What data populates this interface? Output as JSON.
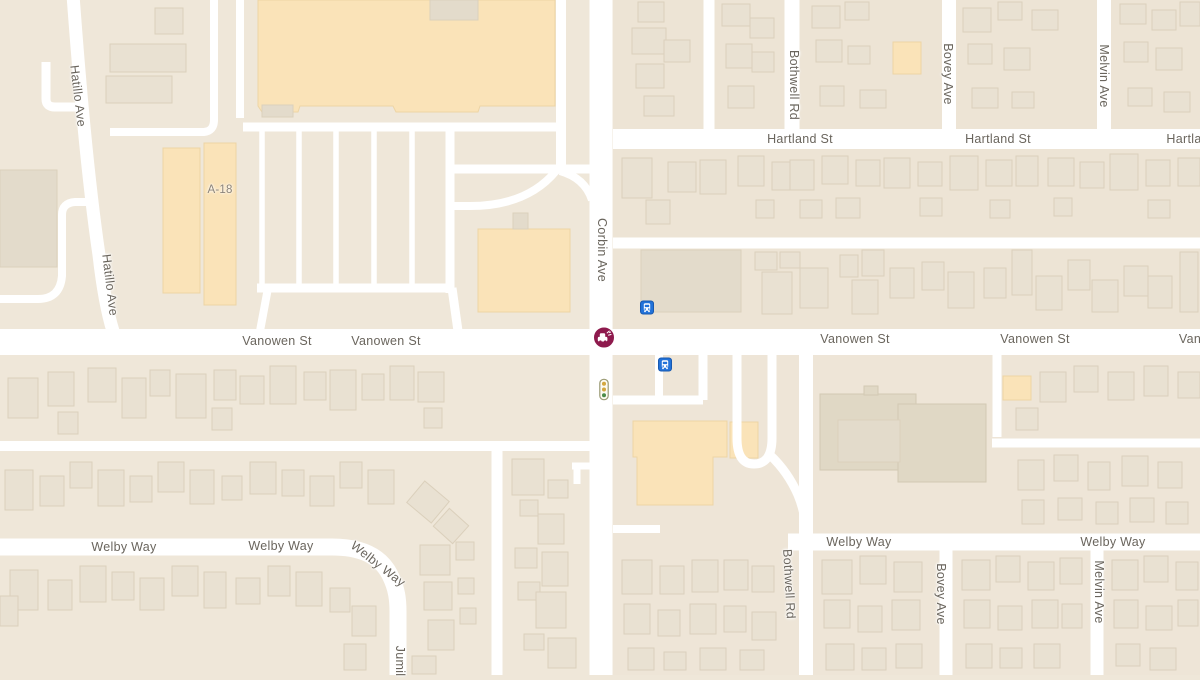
{
  "colors": {
    "background": "#EFE7D9",
    "block_tint": "#EDE4D5",
    "road": "#FFFFFF",
    "building": "#E9E1D2",
    "building_dark": "#E3DBCB",
    "commercial": "#FAE3B8",
    "church": "#E0D8C5",
    "label_text": "#6A655D",
    "incident": "#8E1A4D",
    "bus_blue": "#2272D9",
    "light_amber": "#D3A73F",
    "light_green": "#4C8B47"
  },
  "map": {
    "street_labels": [
      {
        "text": "Hatillo Ave",
        "x": 78,
        "y": 96,
        "rotate": 83
      },
      {
        "text": "Hatillo Ave",
        "x": 110,
        "y": 285,
        "rotate": 83
      },
      {
        "text": "Corbin Ave",
        "x": 602,
        "y": 250,
        "rotate": 90
      },
      {
        "text": "Hartland St",
        "x": 800,
        "y": 139,
        "rotate": 0
      },
      {
        "text": "Hartland St",
        "x": 998,
        "y": 139,
        "rotate": 0
      },
      {
        "text": "Hartla",
        "x": 1184,
        "y": 139,
        "rotate": 0
      },
      {
        "text": "Vanowen St",
        "x": 277,
        "y": 341,
        "rotate": 0
      },
      {
        "text": "Vanowen St",
        "x": 386,
        "y": 341,
        "rotate": 0
      },
      {
        "text": "Vanowen St",
        "x": 855,
        "y": 339,
        "rotate": 0
      },
      {
        "text": "Vanowen St",
        "x": 1035,
        "y": 339,
        "rotate": 0
      },
      {
        "text": "Van",
        "x": 1190,
        "y": 339,
        "rotate": 0
      },
      {
        "text": "Bothwell Rd",
        "x": 794,
        "y": 85,
        "rotate": 90
      },
      {
        "text": "Bothwell Rd",
        "x": 789,
        "y": 584,
        "rotate": 87
      },
      {
        "text": "Bovey Ave",
        "x": 948,
        "y": 74,
        "rotate": 90
      },
      {
        "text": "Bovey Ave",
        "x": 941,
        "y": 594,
        "rotate": 90
      },
      {
        "text": "Melvin Ave",
        "x": 1104,
        "y": 76,
        "rotate": 90
      },
      {
        "text": "Melvin Ave",
        "x": 1099,
        "y": 592,
        "rotate": 90
      },
      {
        "text": "Welby Way",
        "x": 124,
        "y": 547,
        "rotate": 0
      },
      {
        "text": "Welby Way",
        "x": 281,
        "y": 546,
        "rotate": 0
      },
      {
        "text": "Welby Way",
        "x": 378,
        "y": 564,
        "rotate": 38
      },
      {
        "text": "Welby Way",
        "x": 859,
        "y": 542,
        "rotate": 0
      },
      {
        "text": "Welby Way",
        "x": 1113,
        "y": 542,
        "rotate": 0
      },
      {
        "text": "Jumil",
        "x": 400,
        "y": 661,
        "rotate": 90
      }
    ],
    "area_labels": [
      {
        "text": "A-18",
        "x": 220,
        "y": 190
      }
    ],
    "icons": [
      {
        "type": "traffic-incident",
        "x": 604,
        "y": 340,
        "interactable": true
      },
      {
        "type": "bus-stop",
        "x": 647,
        "y": 310,
        "interactable": true
      },
      {
        "type": "bus-stop",
        "x": 665,
        "y": 367,
        "interactable": true
      },
      {
        "type": "traffic-light",
        "x": 604,
        "y": 392,
        "interactable": false
      }
    ]
  }
}
